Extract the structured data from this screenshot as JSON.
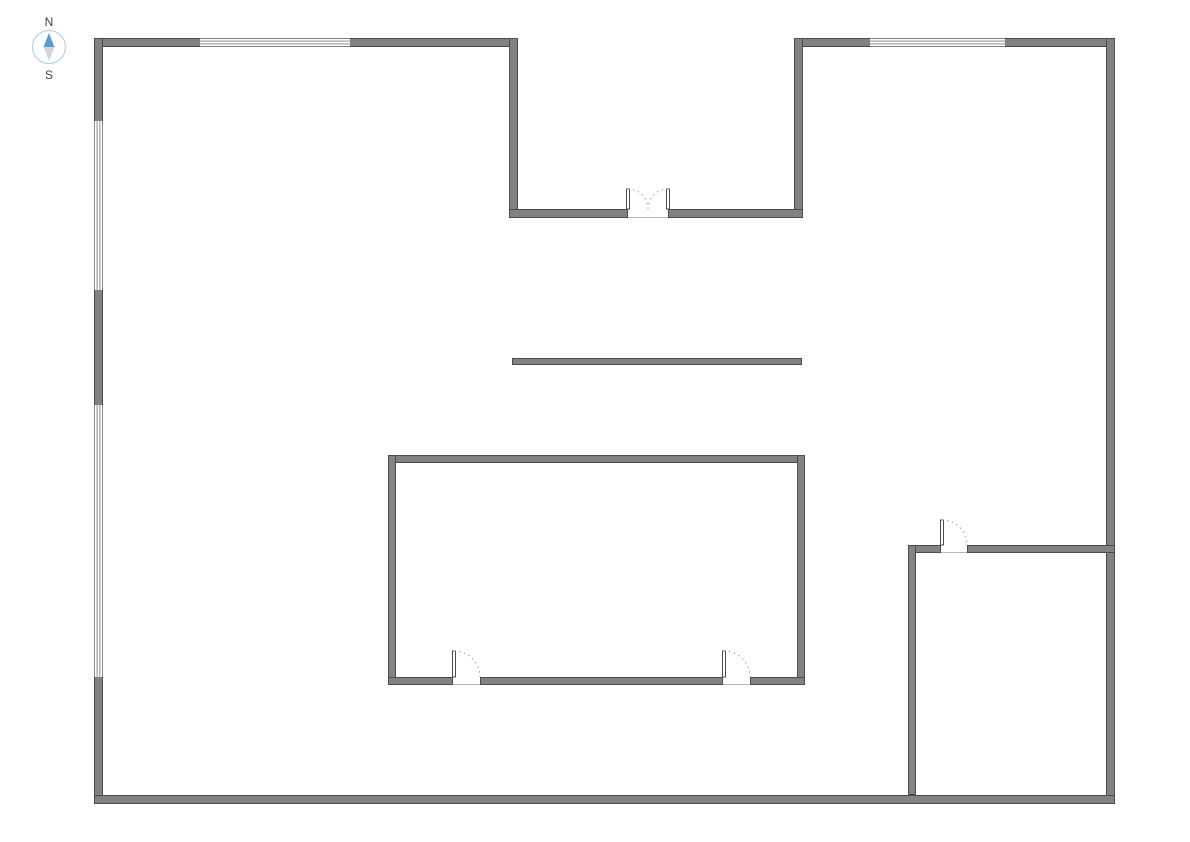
{
  "canvas": {
    "width": 1190,
    "height": 842,
    "background": "#ffffff"
  },
  "compass": {
    "north_label": "N",
    "south_label": "S",
    "label_color": "#404040",
    "ring_color": "#b5d1e6",
    "north_color": "#5b9bd5",
    "south_color": "#cfd6db"
  },
  "style": {
    "wall_fill": "#828282",
    "wall_edge": "#4c4c4c",
    "window_fill": "#ffffff",
    "window_line": "#7d7d7d",
    "door_leaf_fill": "#ffffff",
    "door_leaf_edge": "#4c4c4c",
    "door_arc": "#9e9e9e",
    "threshold": "#b8b8b8"
  },
  "walls": [
    {
      "id": "outer-top-left",
      "x": 94,
      "y": 38,
      "w": 424,
      "h": 9
    },
    {
      "id": "outer-top-right",
      "x": 794,
      "y": 38,
      "w": 321,
      "h": 9
    },
    {
      "id": "outer-left",
      "x": 94,
      "y": 38,
      "w": 9,
      "h": 766
    },
    {
      "id": "outer-right",
      "x": 1106,
      "y": 38,
      "w": 9,
      "h": 766
    },
    {
      "id": "outer-bottom",
      "x": 94,
      "y": 795,
      "w": 1021,
      "h": 9
    },
    {
      "id": "notch-left",
      "x": 509,
      "y": 38,
      "w": 9,
      "h": 180
    },
    {
      "id": "notch-right",
      "x": 794,
      "y": 38,
      "w": 9,
      "h": 180
    },
    {
      "id": "notch-bottom-west",
      "x": 509,
      "y": 209,
      "w": 119,
      "h": 9
    },
    {
      "id": "notch-bottom-east",
      "x": 668,
      "y": 209,
      "w": 135,
      "h": 9
    },
    {
      "id": "divider",
      "x": 512,
      "y": 358,
      "w": 290,
      "h": 7
    },
    {
      "id": "room-top",
      "x": 388,
      "y": 455,
      "w": 417,
      "h": 8
    },
    {
      "id": "room-left",
      "x": 388,
      "y": 455,
      "w": 8,
      "h": 230
    },
    {
      "id": "room-right",
      "x": 797,
      "y": 455,
      "w": 8,
      "h": 230
    },
    {
      "id": "room-bottom-west",
      "x": 388,
      "y": 677,
      "w": 65,
      "h": 8
    },
    {
      "id": "room-bottom-mid",
      "x": 480,
      "y": 677,
      "w": 243,
      "h": 8
    },
    {
      "id": "room-bottom-east",
      "x": 750,
      "y": 677,
      "w": 55,
      "h": 8
    },
    {
      "id": "br-room-top-west",
      "x": 908,
      "y": 545,
      "w": 33,
      "h": 8
    },
    {
      "id": "br-room-top-east",
      "x": 967,
      "y": 545,
      "w": 148,
      "h": 8
    },
    {
      "id": "br-room-left",
      "x": 908,
      "y": 545,
      "w": 8,
      "h": 250
    }
  ],
  "windows": [
    {
      "id": "top-wall-window-west",
      "x": 200,
      "y": 38,
      "w": 150,
      "h": 9,
      "orient": "h"
    },
    {
      "id": "top-wall-window-east",
      "x": 870,
      "y": 38,
      "w": 135,
      "h": 9,
      "orient": "h"
    },
    {
      "id": "left-wall-window-upper",
      "x": 94,
      "y": 121,
      "w": 9,
      "h": 169,
      "orient": "v"
    },
    {
      "id": "left-wall-window-lower",
      "x": 94,
      "y": 405,
      "w": 9,
      "h": 272,
      "orient": "v"
    }
  ],
  "doors": [
    {
      "id": "entry-double-door-left-leaf",
      "hx": 628,
      "hy": 209,
      "r": 20,
      "dir": 1
    },
    {
      "id": "entry-double-door-right-leaf",
      "hx": 668,
      "hy": 209,
      "r": 20,
      "dir": -1
    },
    {
      "id": "center-room-door-west",
      "hx": 454,
      "hy": 677,
      "r": 26,
      "dir": 1
    },
    {
      "id": "center-room-door-east",
      "hx": 724,
      "hy": 677,
      "r": 26,
      "dir": 1
    },
    {
      "id": "br-room-door",
      "hx": 942,
      "hy": 545,
      "r": 25,
      "dir": 1
    }
  ],
  "thresholds": [
    {
      "id": "entry-double-door-threshold",
      "x1": 628,
      "x2": 668,
      "y": 217.5
    },
    {
      "id": "center-room-door-west-threshold",
      "x1": 453,
      "x2": 480,
      "y": 684.5
    },
    {
      "id": "center-room-door-east-threshold",
      "x1": 723,
      "x2": 750,
      "y": 684.5
    },
    {
      "id": "br-room-door-threshold",
      "x1": 941,
      "x2": 967,
      "y": 552.5
    }
  ]
}
